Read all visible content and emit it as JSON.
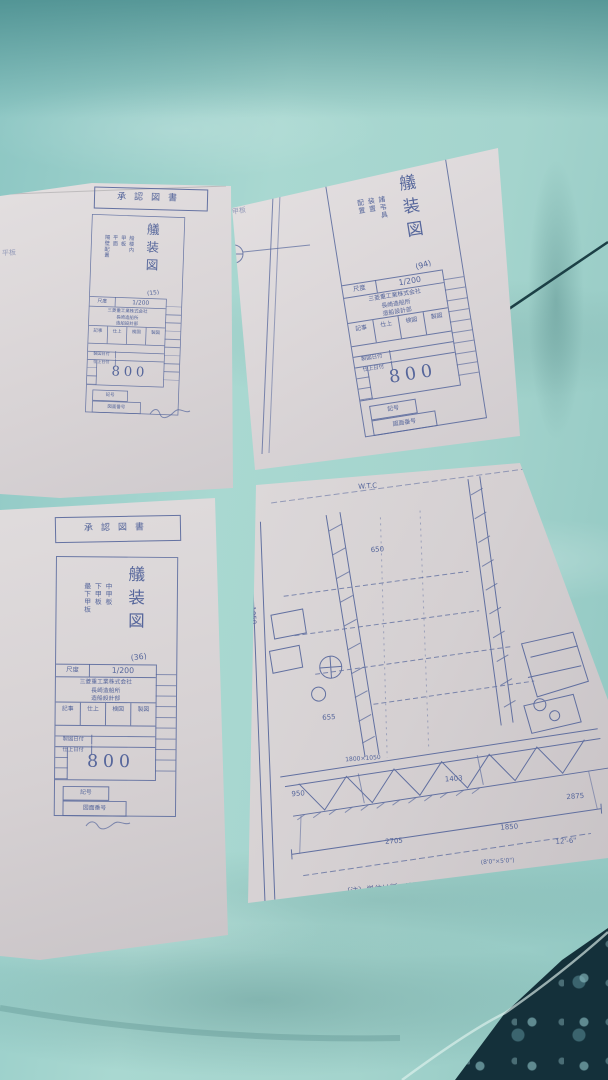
{
  "colors": {
    "fabric_teal": "#9ccfc9",
    "fabric_dark_band": "#3a8082",
    "dark_blanket": "#14303a",
    "paper": "#dbd6d7",
    "blueprint_ink": "#56669b",
    "cord": "#1c4046"
  },
  "papers": {
    "p1": {
      "stamp": "承認図書",
      "title": "艤装図",
      "subtitle": "船楼内\n甲板\n平面\n隔壁配置",
      "sheet_no": "(15)",
      "scale_label": "尺度",
      "scale_value": "1/200",
      "company": "三菱重工業株式会社\n長崎造船所\n造船設計部",
      "approvals": [
        "記事",
        "仕上",
        "検図",
        "製図"
      ],
      "date_row1": "製図日付",
      "date_row2": "仕上日付",
      "number": "800",
      "box1": "記号",
      "box2": "図面番号",
      "margin_note": "平板"
    },
    "p2": {
      "title": "艤装図",
      "subtitle": "諸弔具\n装置\n配置",
      "sheet_no": "(94)",
      "scale_label": "尺度",
      "scale_value": "1/200",
      "company": "三菱重工業株式会社\n長崎造船所\n造船設計部",
      "approvals": [
        "記事",
        "仕上",
        "検図",
        "製図"
      ],
      "date_row1": "製図日付",
      "date_row2": "仕上日付",
      "number": "800",
      "box1": "記号",
      "box2": "図面番号",
      "margin_note": "甲板"
    },
    "p3": {
      "stamp": "承認図書",
      "title": "艤装図",
      "subtitle": "中甲板\n下甲板\n最下甲板",
      "sheet_no": "(36)",
      "scale_label": "尺度",
      "scale_value": "1/200",
      "company": "三菱重工業株式会社\n長崎造船所\n造船設計部",
      "approvals": [
        "記事",
        "仕上",
        "検図",
        "製図"
      ],
      "date_row1": "製図日付",
      "date_row2": "仕上日付",
      "number": "800",
      "box1": "記号",
      "box2": "図面番号"
    },
    "p4": {
      "note1": "〔注〕単位は粍　WTC＝水防区画　WT＝水倉　№",
      "note2": "RFWT＝予備給水タンク　OT＝燃料油タンク",
      "dims": [
        "7050",
        "1050",
        "650",
        "W.T.C",
        "№7",
        "655",
        "1800×1050",
        "1403",
        "950",
        "2705",
        "1850",
        "2875",
        "12'-6\"",
        "(8'0\"×5'0\")"
      ]
    }
  }
}
